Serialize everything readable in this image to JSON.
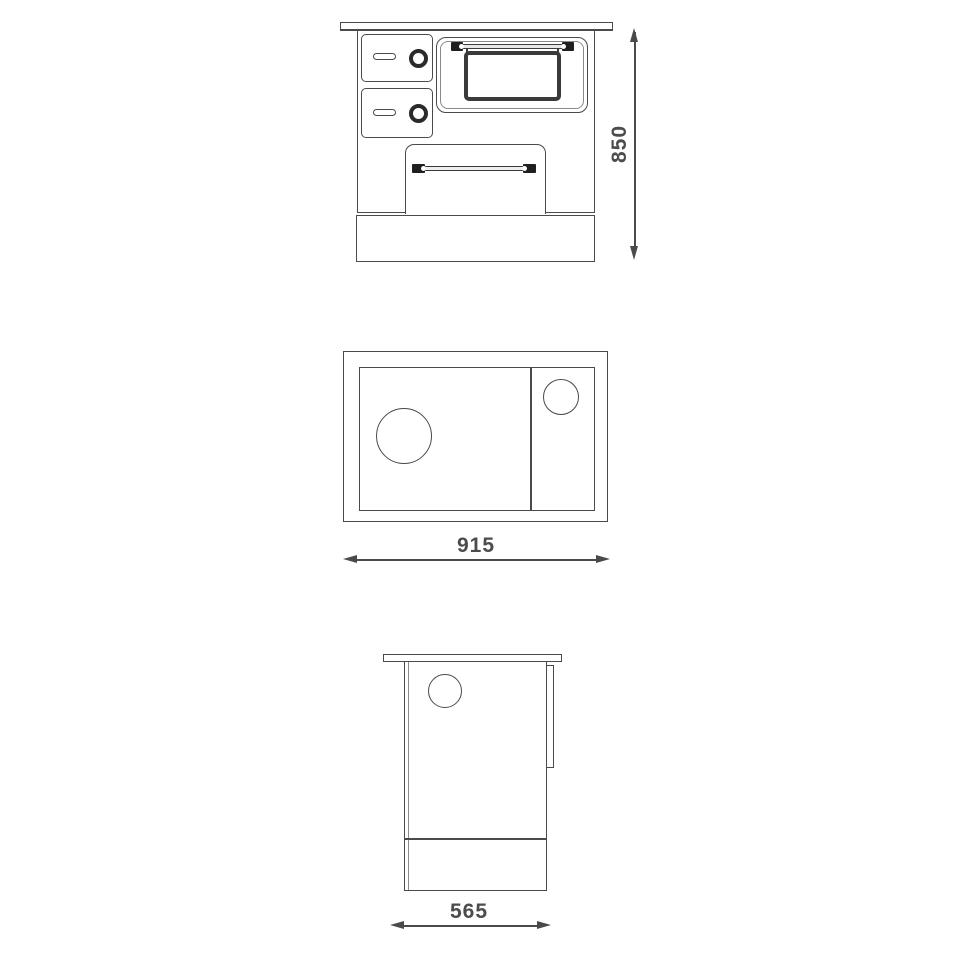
{
  "colors": {
    "background": "#ffffff",
    "line": "#4a4a4a",
    "dark_accent": "#1f1f1f",
    "text": "#4c4c4c"
  },
  "dimensions": {
    "front_height": "850",
    "top_width": "915",
    "side_depth": "565"
  }
}
